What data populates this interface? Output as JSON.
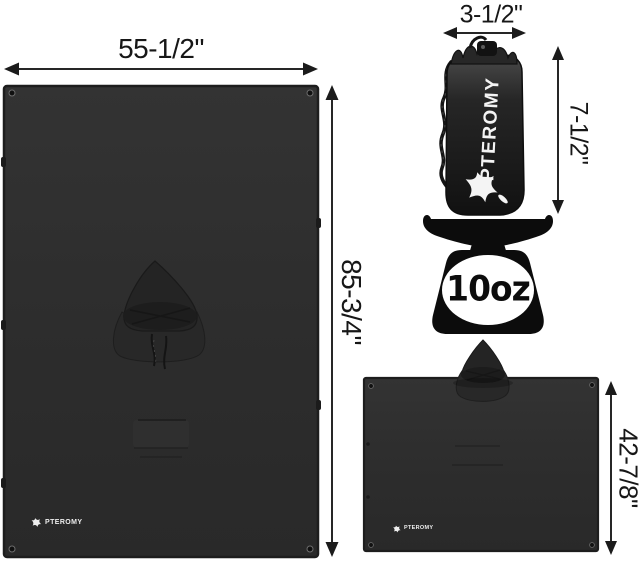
{
  "brand": "PTEROMY",
  "colors": {
    "background": "#ffffff",
    "fabric": "#2d2d2d",
    "fabric_shadow": "#1f1f1f",
    "ink": "#171717",
    "logo_white": "#f4f4f4"
  },
  "tarp_flat": {
    "width_label": "55-1/2\"",
    "height_label": "85-3/4\"",
    "brand": "PTEROMY"
  },
  "stuff_sack": {
    "width_label": "3-1/2\"",
    "height_label": "7-1/2\"",
    "brand": "PTEROMY"
  },
  "scale": {
    "weight_label": "10oz"
  },
  "poncho": {
    "height_label": "42-7/8\"",
    "brand": "PTEROMY"
  }
}
